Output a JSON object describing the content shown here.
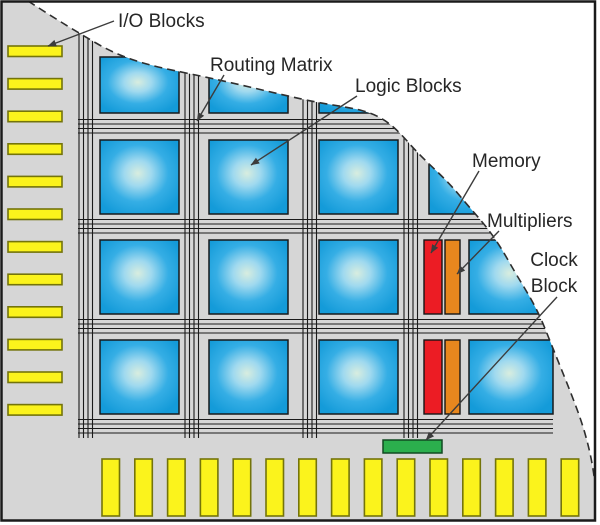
{
  "diagram_title": "FPGA chip architecture diagram",
  "colors": {
    "background": "#ffffff",
    "chip_fill": "#d6d6d6",
    "frame": "#1a1a1a",
    "routing_line": "#1a1a1a",
    "dashed_boundary": "#2e2e2e",
    "logic_center": "#d8eddf",
    "logic_mid": "#9fd9ef",
    "logic_edge2": "#35aee5",
    "logic_edge": "#149bd9",
    "logic_border": "#17191b",
    "io_fill": "#fbf31c",
    "io_border": "#74740a",
    "memory_fill": "#ec1c24",
    "memory_border": "#151515",
    "multiplier_fill": "#e8871e",
    "multiplier_border": "#151515",
    "clock_fill": "#2baf4d",
    "clock_border": "#114a22",
    "label_text": "#262626",
    "arrow": "#3c3c3c"
  },
  "chip": {
    "outline_d": "M2.5,2.5 L28,1 C45,12 70,28 96,43 C125,60 152,66 186,73 C235,83 265,91 306,100 C330,105 342,106 360,110 C382,116 392,124 408,142 C428,165 440,172 460,196 C478,218 490,228 508,260 C526,292 534,300 548,336 C560,366 570,390 578,412 C586,434 592,458 594.5,480 L594.5,519.5 L2.5,519.5 Z",
    "curve_d": "M28,1 C45,12 70,28 96,43 C125,60 152,66 186,73 C235,83 265,91 306,100 C330,105 342,106 360,110 C382,116 392,124 408,142 C428,165 440,172 460,196 C478,218 490,228 508,260 C526,292 534,300 548,336 C560,366 570,390 578,412 C586,434 592,458 594.5,480"
  },
  "routing": {
    "h_channels": [
      119.5,
      219.5,
      319.5,
      419.5
    ],
    "v_channels": [
      79,
      185,
      303,
      404
    ],
    "lines_per_channel": 4,
    "line_spacing": 4.5,
    "h_extent": [
      78,
      553
    ],
    "v_extent": [
      15,
      438
    ]
  },
  "logic_blocks": {
    "width": 79,
    "height": 74,
    "positions": [
      [
        100,
        57,
        79,
        56
      ],
      [
        209,
        57,
        79,
        56
      ],
      [
        319,
        57,
        79,
        56
      ],
      [
        429,
        57,
        79,
        56
      ],
      [
        100,
        140
      ],
      [
        209,
        140
      ],
      [
        319,
        140
      ],
      [
        429,
        140
      ],
      [
        100,
        240
      ],
      [
        209,
        240
      ],
      [
        319,
        240
      ],
      [
        469,
        240,
        84,
        74
      ],
      [
        100,
        340
      ],
      [
        209,
        340
      ],
      [
        319,
        340
      ],
      [
        469,
        340,
        84,
        74
      ]
    ]
  },
  "memory_blocks": {
    "width": 18,
    "height": 74,
    "positions": [
      [
        424,
        240
      ],
      [
        424,
        340
      ]
    ]
  },
  "multiplier_blocks": {
    "width": 15,
    "height": 74,
    "positions": [
      [
        445,
        240
      ],
      [
        445,
        340
      ]
    ]
  },
  "clock_block": {
    "x": 383,
    "y": 440,
    "width": 59,
    "height": 13
  },
  "io_blocks_left": {
    "x": 8,
    "width": 54,
    "height": 10.5,
    "y_start": 46,
    "pitch": 32.6,
    "count": 12
  },
  "io_blocks_bottom": {
    "y": 459,
    "width": 17.5,
    "height": 57,
    "x_start": 102,
    "pitch": 32.8,
    "count": 15
  },
  "labels": [
    {
      "id": "io-blocks",
      "text": "I/O Blocks",
      "x": 118,
      "y": 27,
      "anchor": "start",
      "arrow": [
        114,
        21,
        48,
        46
      ]
    },
    {
      "id": "routing-matrix",
      "text": "Routing Matrix",
      "x": 210,
      "y": 71,
      "anchor": "start",
      "arrow": [
        224,
        75,
        197,
        121
      ]
    },
    {
      "id": "logic-blocks",
      "text": "Logic Blocks",
      "x": 355,
      "y": 92,
      "anchor": "start",
      "arrow": [
        357,
        96,
        251,
        165
      ]
    },
    {
      "id": "memory",
      "text": "Memory",
      "x": 472,
      "y": 167,
      "anchor": "start",
      "arrow": [
        479,
        171,
        431,
        253
      ]
    },
    {
      "id": "multipliers",
      "text": "Multipliers",
      "x": 487,
      "y": 227,
      "anchor": "start",
      "arrow": [
        499,
        231,
        457,
        274
      ]
    },
    {
      "id": "clock",
      "text": "Clock",
      "x": 554,
      "y": 266,
      "anchor": "middle",
      "arrow": null
    },
    {
      "id": "clock-block",
      "text": "Block",
      "x": 554,
      "y": 292,
      "anchor": "middle",
      "arrow": [
        557,
        297,
        426,
        440
      ]
    }
  ],
  "font_size_px": 19
}
